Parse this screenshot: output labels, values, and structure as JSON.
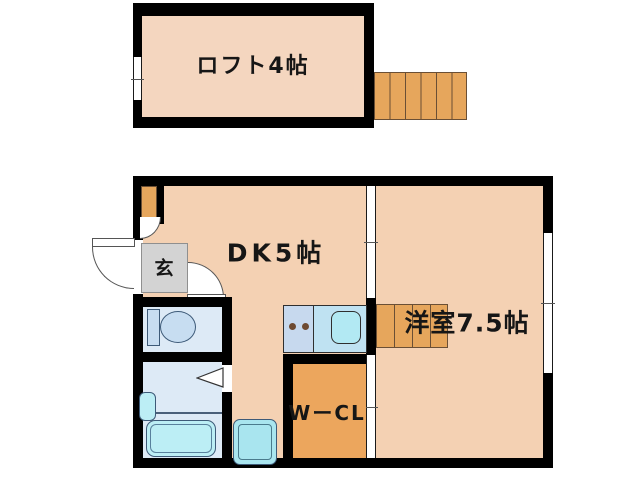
{
  "plan": {
    "title": "apartment-floor-plan",
    "labels": {
      "loft": "ロフト4帖",
      "dk": "DK5帖",
      "western": "洋室7.5帖",
      "entrance": "玄",
      "closet": "WーCL"
    },
    "colors": {
      "wall": "#000000",
      "loft_floor": "#f4d6bf",
      "room_floor": "#f4d1b3",
      "stairs": "#e6a65c",
      "closet": "#eca65d",
      "entrance": "#d3d3d3",
      "wet_room": "#ddeaf6",
      "fixture": "#c7ddf1",
      "tub": "#bceef5",
      "pan": "#a9e5ef",
      "counter_left": "#c7d9ee",
      "counter_right": "#bfe2f2",
      "kitchen_sink": "#b2e9f3",
      "burner": "#6e4a31"
    },
    "fixtures": [
      "loft-stairs",
      "room-stairs",
      "loft-ladder-step",
      "toilet",
      "bathtub",
      "washbasin",
      "bathroom-folding-door",
      "kitchen-counter",
      "gas-burners",
      "kitchen-sink",
      "washing-machine-pan",
      "entrance-door",
      "entrance-hall-door",
      "sliding-door",
      "window"
    ]
  }
}
